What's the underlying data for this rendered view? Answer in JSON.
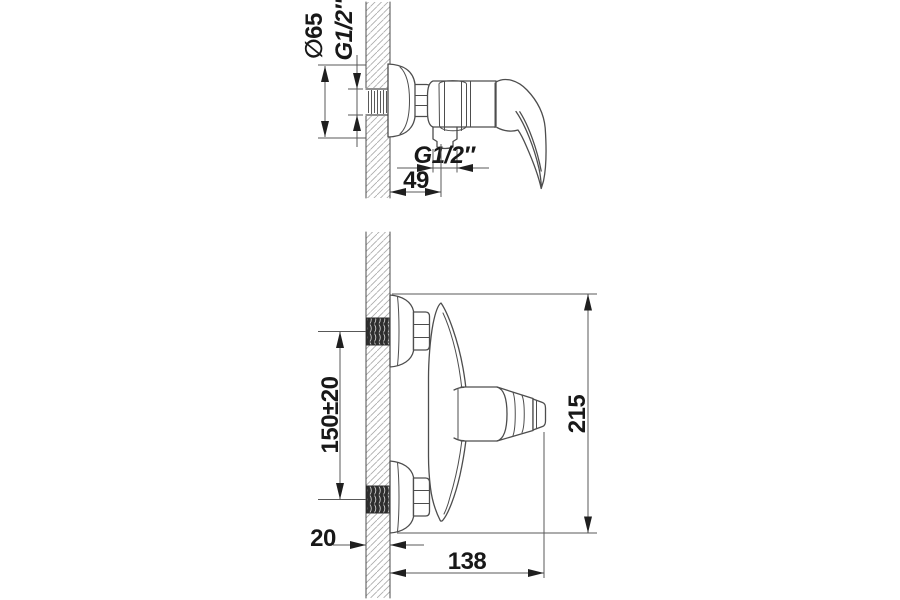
{
  "drawing": {
    "kind": "dimensioned technical line drawing",
    "views": [
      "side-section",
      "front-section"
    ]
  },
  "colors": {
    "background": "#ffffff",
    "outline": "#4d4d4d",
    "hatch": "#aaaaaa",
    "thread_block": "#2e2e2e",
    "dimension_line": "#585858",
    "text": "#181818"
  },
  "side_view": {
    "dia_label": "∅65",
    "inlet_thread_label": "G1/2″",
    "outlet_thread_label": "G1/2″",
    "offset_label": "49"
  },
  "front_view": {
    "spacing_label": "150±20",
    "height_label": "215",
    "wall_thickness_label": "20",
    "depth_label": "138"
  }
}
